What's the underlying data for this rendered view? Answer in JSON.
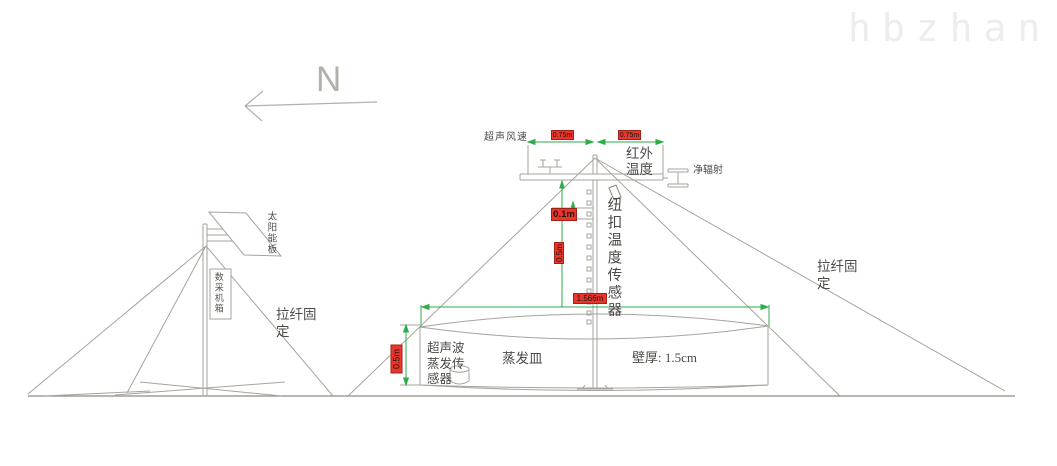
{
  "watermark": "hbzhan.com",
  "north": {
    "label": "N"
  },
  "left_tower": {
    "solar_panel_label": "太阳能板",
    "logger_box_label": "数采机箱",
    "guy_wire_label": "拉纤固定"
  },
  "main_station": {
    "wind_sensor_label": "超声风速",
    "ir_temp_label": "红外温度",
    "net_radiation_label": "净辐射",
    "button_sensor_label": "纽扣温度传感器",
    "evap_sensor_label": "超声波蒸发传感器",
    "pan_label": "蒸发皿",
    "wall_thickness_label": "壁厚: 1.5cm",
    "guy_wire_label": "拉纤固定"
  },
  "dimensions": {
    "left_arm": "0.75m",
    "right_arm": "0.75m",
    "sensor_offset": "0.1m",
    "pole_section": "0.5m",
    "pan_diameter": "1.566m",
    "pan_depth": "0.5m"
  },
  "colors": {
    "line": "#a7a39d",
    "dimension_green": "#2fae49",
    "chip_red": "#e8362c"
  }
}
